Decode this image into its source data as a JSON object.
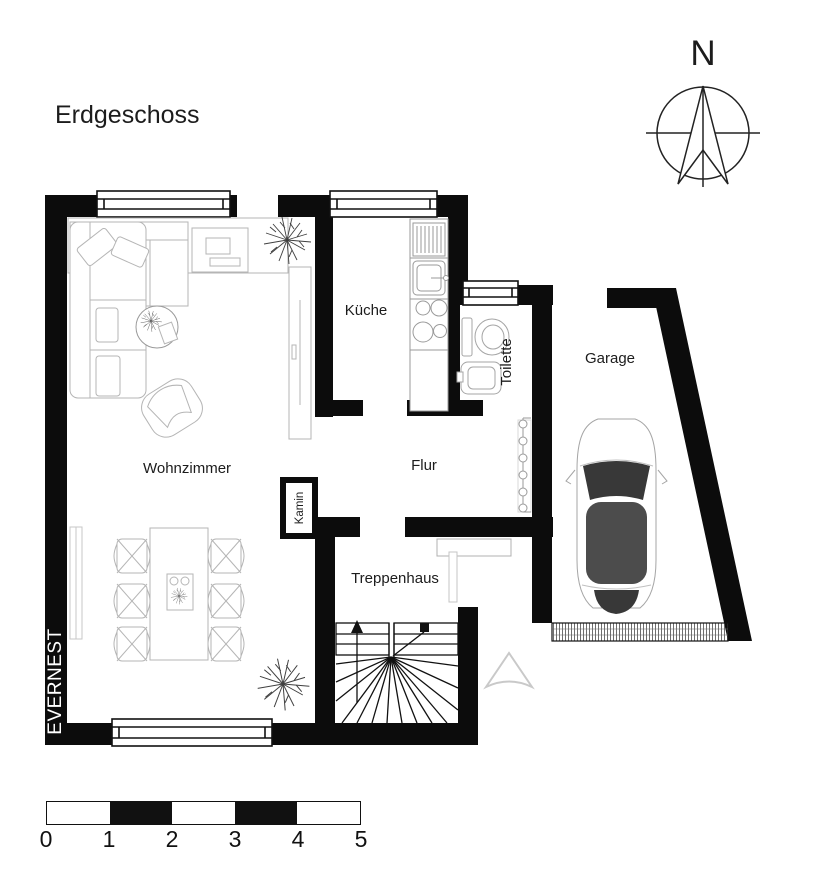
{
  "title": "Erdgeschoss",
  "brand": "EVERNEST",
  "compass": {
    "north_label": "N"
  },
  "rooms": {
    "wohnzimmer": "Wohnzimmer",
    "kueche": "Küche",
    "toilette": "Toilette",
    "flur": "Flur",
    "treppenhaus": "Treppenhaus",
    "garage": "Garage",
    "kamin": "Kamin"
  },
  "scale_bar": {
    "labels": [
      "0",
      "1",
      "2",
      "3",
      "4",
      "5"
    ],
    "segments": 5
  },
  "colors": {
    "wall": "#0c0c0c",
    "background": "#ffffff",
    "furniture_outline": "#b5b5b5",
    "fixture_outline": "#9a9a9a",
    "car_dark": "#3f3f3f",
    "entrance_marker": "#c9c9c9"
  }
}
